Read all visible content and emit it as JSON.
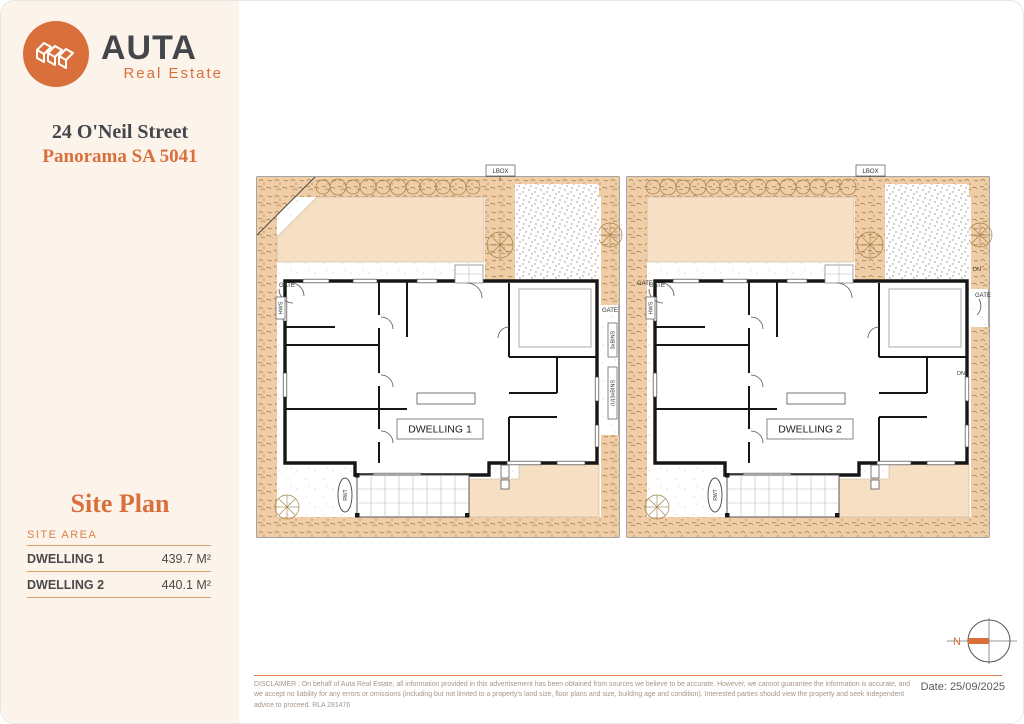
{
  "colors": {
    "accent": "#d9703c",
    "accent_light": "#d9824f",
    "ink": "#43464b",
    "wall": "#161616",
    "garden": "#f0cda6",
    "garden_line": "#a08049",
    "lawn": "#f6dfc3",
    "sidebar_bg": "#fcf3eb"
  },
  "sidebar": {
    "logo": {
      "brand": "AUTA",
      "tagline": "Real Estate",
      "mark": "isometric-houses-icon"
    },
    "address_line1": "24 O'Neil Street",
    "address_line2": "Panorama SA 5041",
    "site_plan_title": "Site Plan",
    "site_area": {
      "heading": "SITE AREA",
      "rows": [
        {
          "label": "DWELLING 1",
          "value": "439.7 M²"
        },
        {
          "label": "DWELLING 2",
          "value": "440.1 M²"
        }
      ]
    }
  },
  "plan": {
    "dwellings": [
      {
        "name": "DWELLING 1"
      },
      {
        "name": "DWELLING 2"
      }
    ],
    "labels": {
      "lbox": "LBOX",
      "gate": "GATE",
      "hws": "HWS",
      "bins": "3xBINS",
      "bins_u": "(U)3xBINS",
      "rwt": "RWT",
      "dn": "DN"
    }
  },
  "compass": {
    "north_label": "N"
  },
  "footer": {
    "disclaimer": "DISCLAIMER : On behalf of Auta Real Estate, all information provided in this advertisement has been obtained from sources we believe to be accurate. However, we cannot guarantee the information is accurate, and we accept no liability for any errors or omissions (including but not limited to a property's land size, floor plans and size, building age and condition). Interested parties should view the property and seek independent advice to proceed. RLA 281476",
    "date_label": "Date: 25/09/2025"
  }
}
